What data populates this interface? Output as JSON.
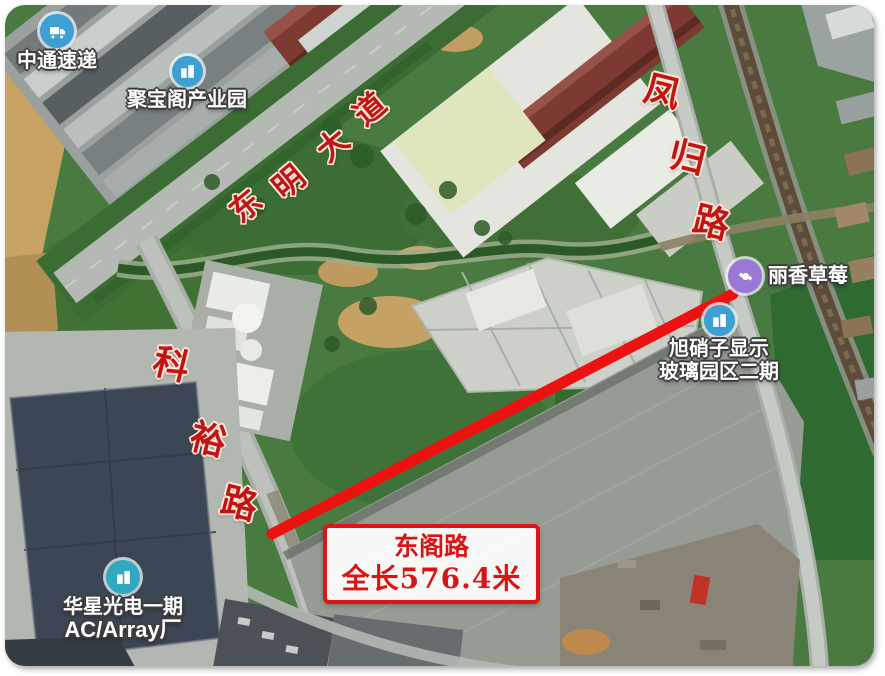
{
  "map": {
    "type": "satellite",
    "route_annotation": {
      "road_name": "东阁路",
      "length_label": "全长576.4米",
      "line_color": "#ee1111"
    },
    "road_labels": {
      "dongming": {
        "name": "东明大道",
        "chars": [
          "东",
          "明",
          "大",
          "道"
        ]
      },
      "keyu": {
        "name": "科裕路",
        "chars": [
          "科",
          "裕",
          "路"
        ]
      },
      "fenggui": {
        "name": "凤归路",
        "chars": [
          "凤",
          "归",
          "路"
        ]
      }
    },
    "pois": [
      {
        "name": "中通速递",
        "icon": "truck-icon",
        "color": "#3d9fd2"
      },
      {
        "name": "聚宝阁产业园",
        "icon": "building-icon",
        "color": "#3d9fd2"
      },
      {
        "name": "丽香草莓",
        "icon": "candy-icon",
        "color": "#9b77d6"
      },
      {
        "name": "旭硝子显示",
        "name2": "玻璃园区二期",
        "icon": "building-icon",
        "color": "#3d9fd2"
      },
      {
        "name": "华星光电一期",
        "name2": "AC/Array厂",
        "icon": "building-icon",
        "color": "#2fa9c0"
      }
    ]
  }
}
